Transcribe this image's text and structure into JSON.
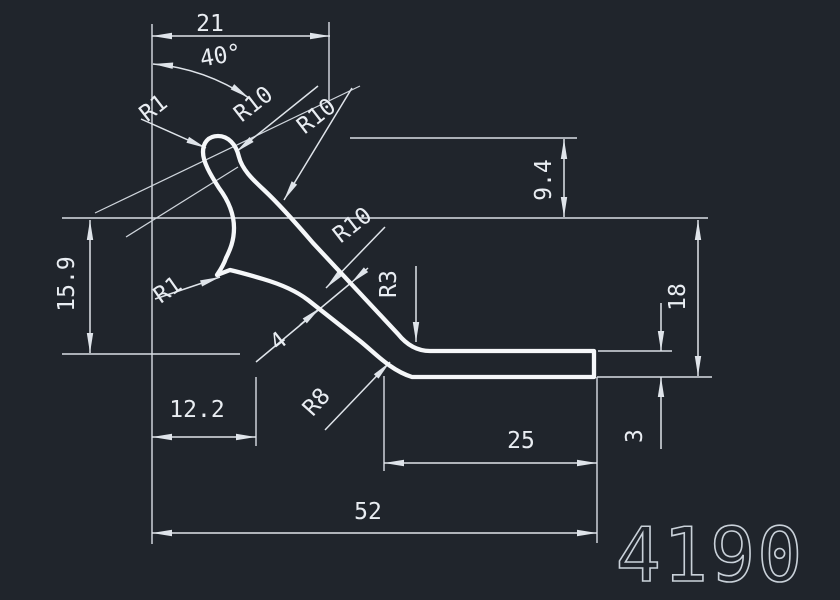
{
  "colors": {
    "background": "#20252c",
    "geometry": "#f5f7f9",
    "dimension": "#dfe4ea",
    "part_label": "#c9d1d9"
  },
  "part_number": "4190",
  "dims": {
    "top_width": "21",
    "angle": "40°",
    "tip_radius": "R1",
    "knob_radius": "R10",
    "neck_radius": "R10",
    "web_radius": "R10",
    "notch_radius": "R1",
    "web_thickness": "4",
    "web_corner_radius": "R3",
    "heel_radius": "R8",
    "tip_drop": "9.4",
    "left_height": "15.9",
    "right_height": "18",
    "flange_thickness": "3",
    "notch_offset": "12.2",
    "flange_length": "25",
    "total_width": "52"
  }
}
